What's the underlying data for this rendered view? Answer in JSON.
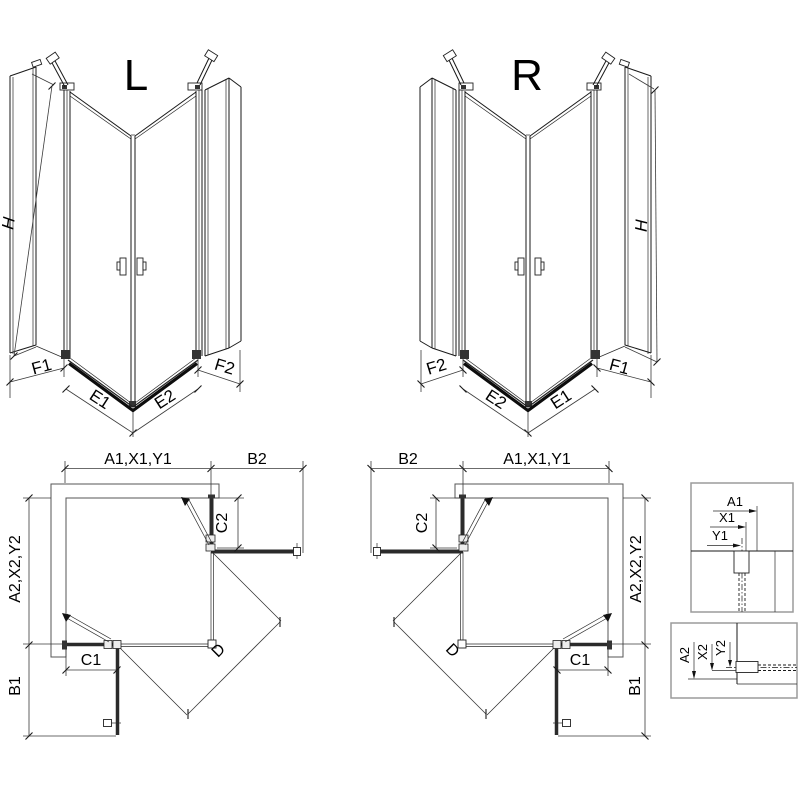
{
  "diagram": {
    "left3d": {
      "title": "L",
      "height_label": "H",
      "bottom_labels": {
        "f1": "F1",
        "e1": "E1",
        "e2": "E2",
        "f2": "F2"
      }
    },
    "right3d": {
      "title": "R",
      "height_label": "H",
      "bottom_labels": {
        "f1": "F1",
        "e1": "E1",
        "e2": "E2",
        "f2": "F2"
      }
    },
    "left_plan": {
      "width_label": "A1,X1,Y1",
      "side_label": "A2,X2,Y2",
      "b2": "B2",
      "c2": "C2",
      "c1": "C1",
      "b1": "B1",
      "d": "D"
    },
    "right_plan": {
      "width_label": "A1,X1,Y1",
      "side_label": "A2,X2,Y2",
      "b2": "B2",
      "c2": "C2",
      "c1": "C1",
      "b1": "B1",
      "d": "D"
    },
    "detail_top": {
      "a1": "A1",
      "x1": "X1",
      "y1": "Y1"
    },
    "detail_bottom": {
      "a2": "A2",
      "x2": "X2",
      "y2": "Y2"
    }
  },
  "colors": {
    "line": "#1a1a1a",
    "dim_line": "#3a3a3a",
    "glass": "#2b2b2b",
    "wall_hatch": "#333333",
    "detail_box_border": "#9b9b9b",
    "background": "#ffffff",
    "text": "#000000"
  }
}
